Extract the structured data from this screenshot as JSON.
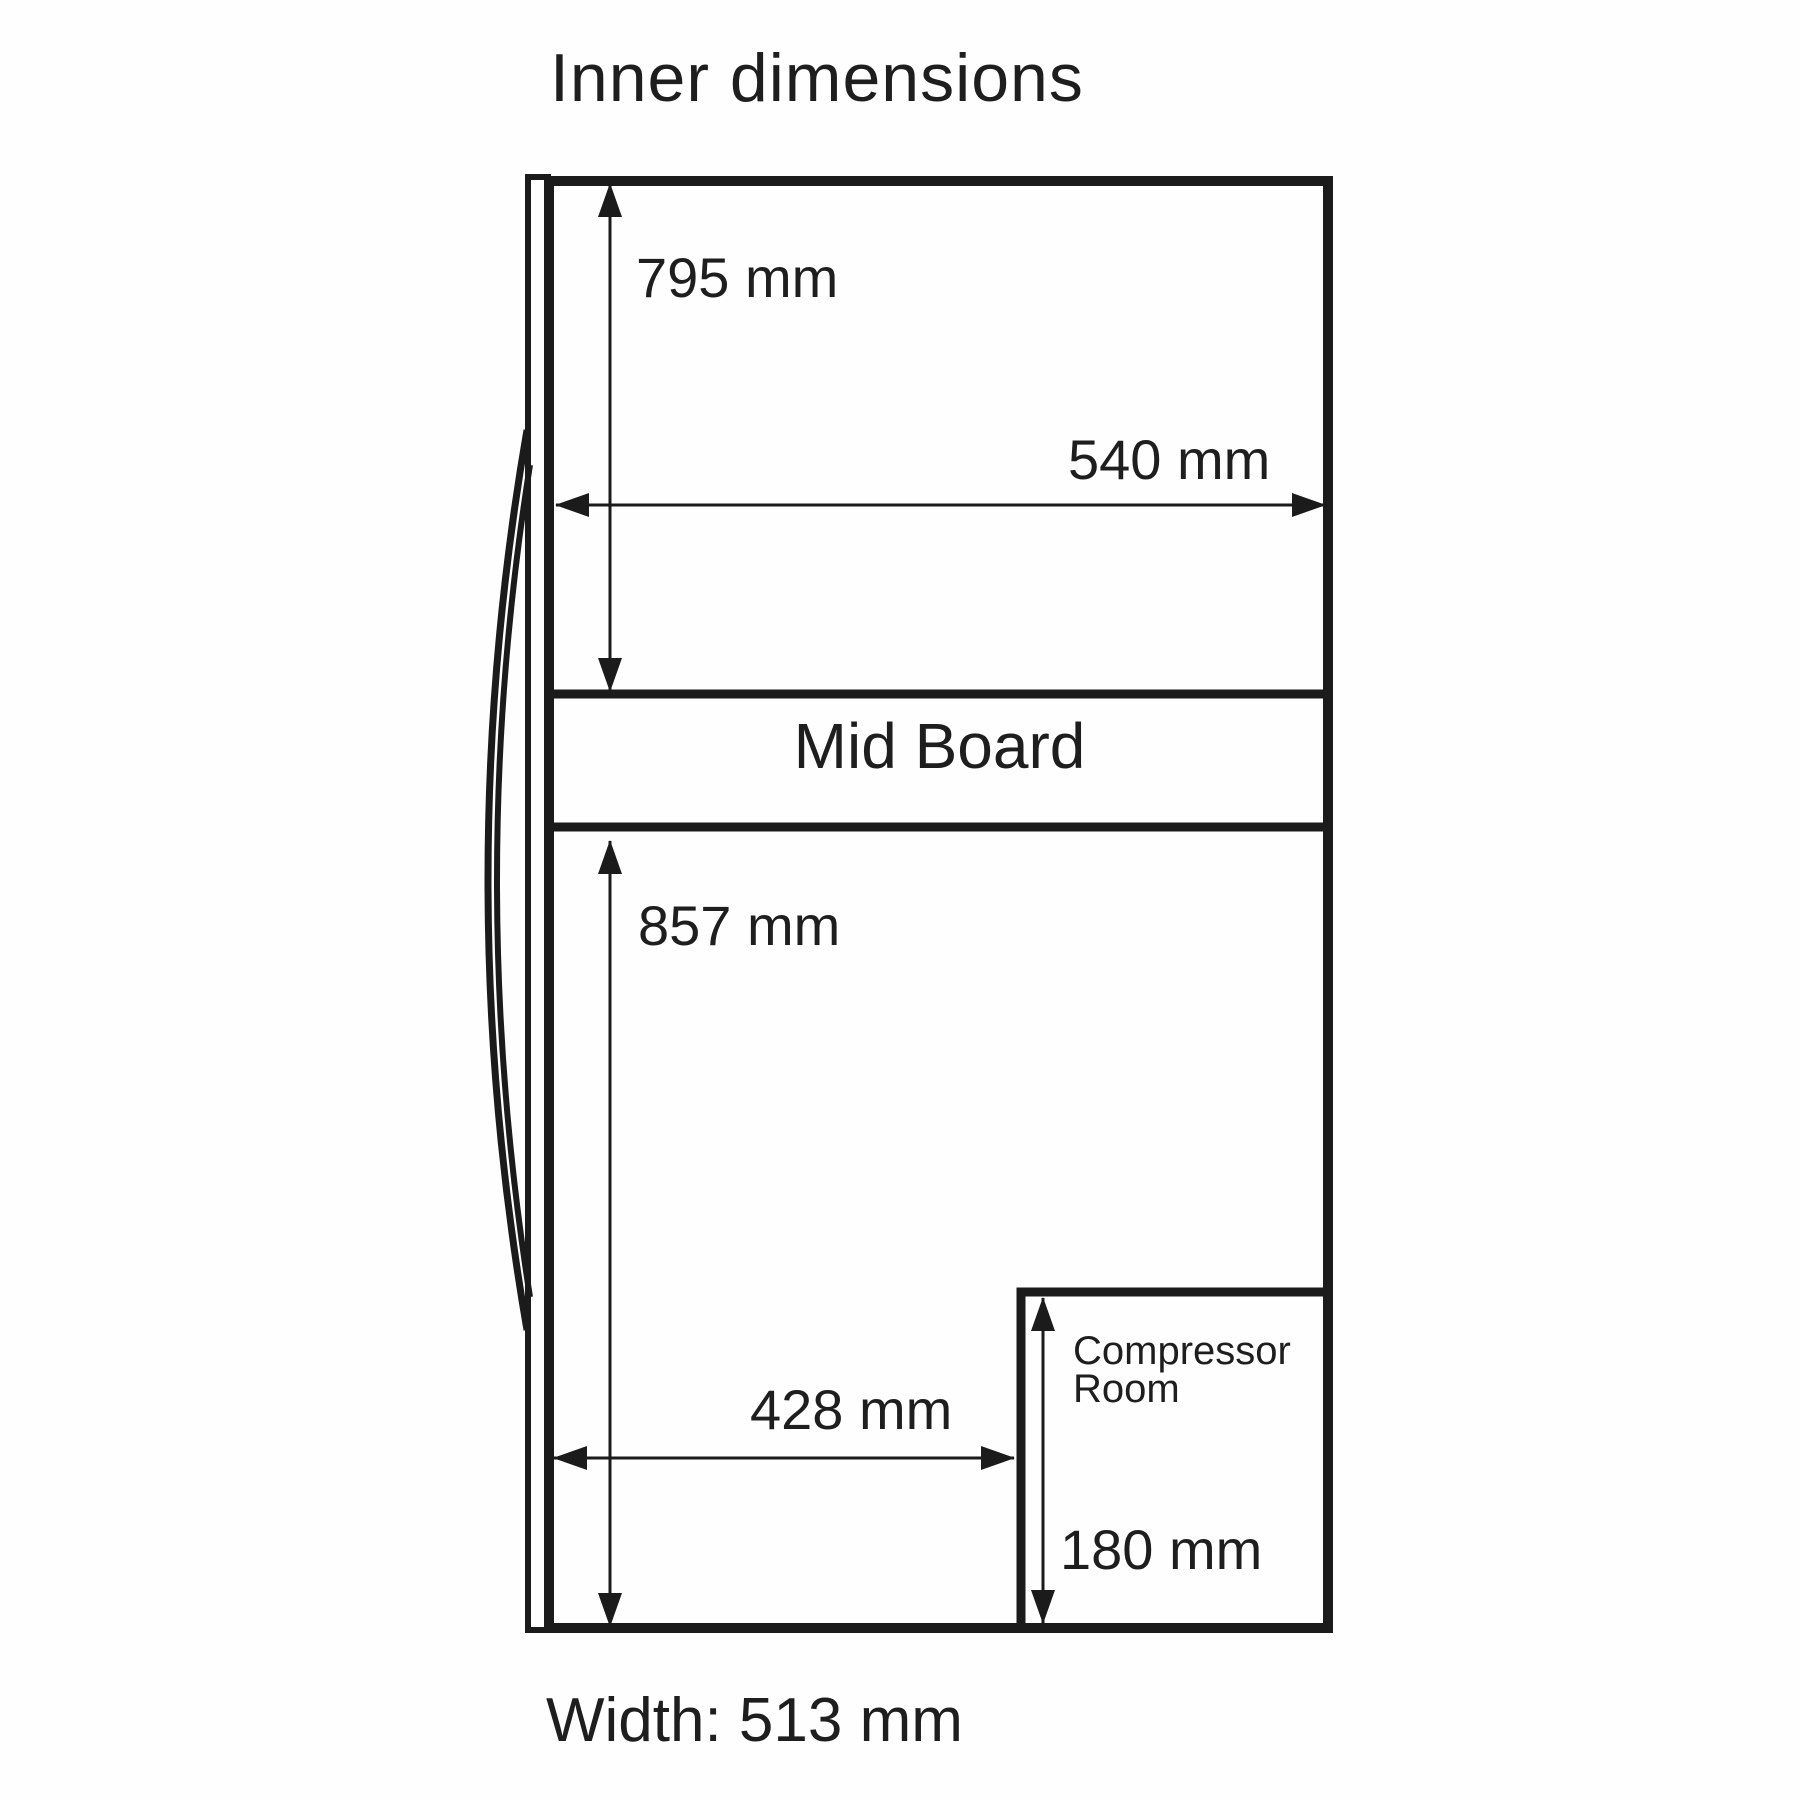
{
  "title": "Inner dimensions",
  "diagram": {
    "labels": {
      "top_compartment_height": "795 mm",
      "top_compartment_width": "540 mm",
      "mid_board": "Mid Board",
      "bottom_compartment_height": "857 mm",
      "bottom_compartment_width": "428 mm",
      "compressor_room_line1": "Compressor",
      "compressor_room_line2": "Room",
      "compressor_room_height": "180 mm",
      "overall_width": "Width: 513 mm"
    },
    "colors": {
      "line": "#1b1b1b",
      "text": "#1e1e1e",
      "background": "#fefefe"
    }
  }
}
